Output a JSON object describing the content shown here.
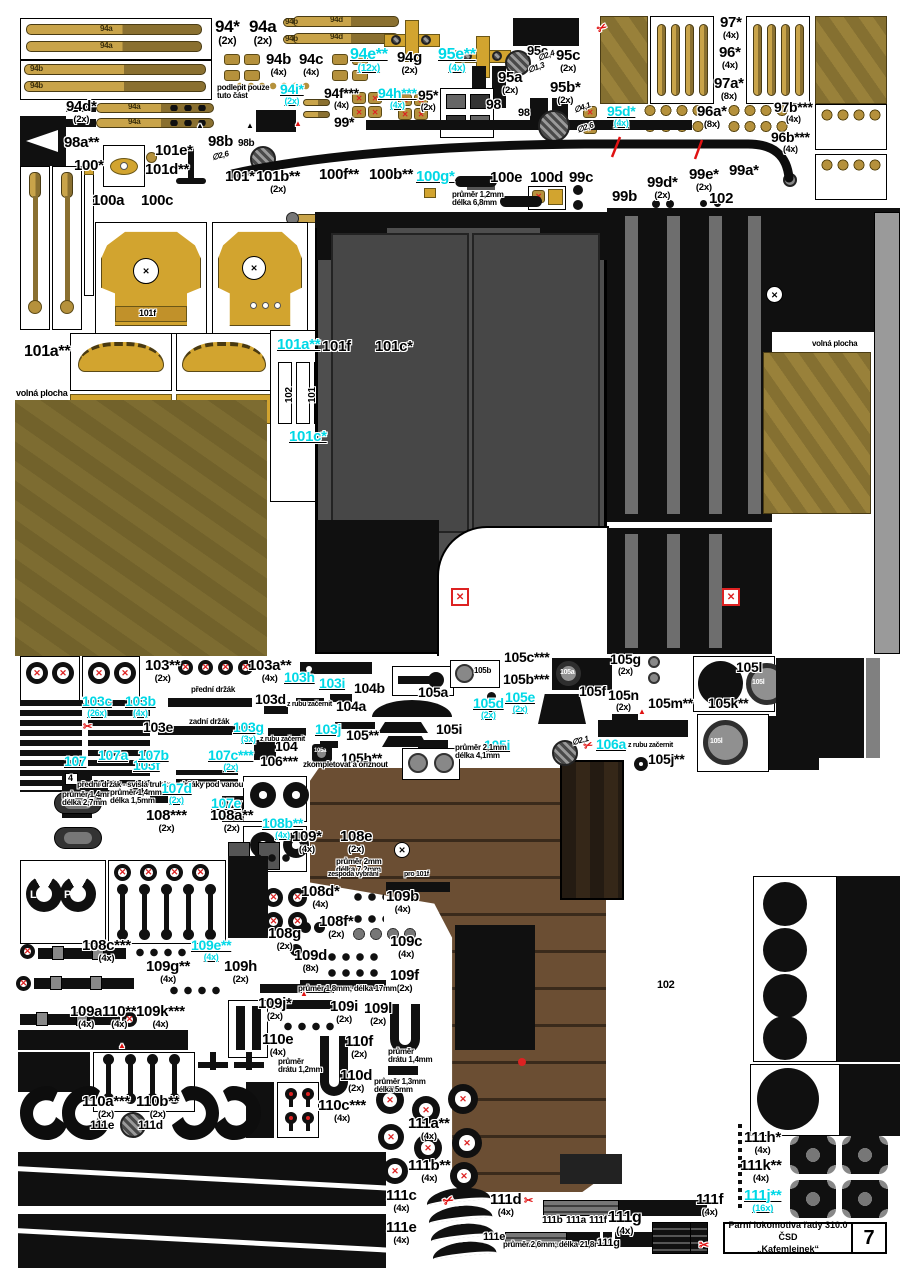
{
  "title_block": {
    "line1": "Parní lokomotiva řady 310.0 ČSD",
    "line2": "„Kafemlejnek“",
    "page": "7"
  },
  "colors": {
    "cyan_accent": "#00d8e6",
    "red_marks": "#e01212",
    "gold": "#c9a44a",
    "dark_gold": "#8a7030",
    "grey_panel": "#4e4e4e",
    "wood": "#6b4e33"
  },
  "labels": [
    {
      "t": "94*",
      "q": "(2x)",
      "x": 215,
      "y": 18,
      "s": 17
    },
    {
      "t": "94a",
      "q": "(2x)",
      "x": 249,
      "y": 18,
      "s": 17
    },
    {
      "t": "94b",
      "q": "(4x)",
      "x": 266,
      "y": 52
    },
    {
      "t": "94c",
      "q": "(4x)",
      "x": 299,
      "y": 52
    },
    {
      "t": "94e**",
      "q": "(12x)",
      "x": 350,
      "y": 47,
      "s": 16,
      "c": "c"
    },
    {
      "t": "94g",
      "q": "(2x)",
      "x": 397,
      "y": 50
    },
    {
      "t": "95e**",
      "q": "(4x)",
      "x": 438,
      "y": 47,
      "s": 16,
      "c": "c"
    },
    {
      "t": "95c",
      "x": 527,
      "y": 44,
      "s": 13
    },
    {
      "t": "95c",
      "q": "(2x)",
      "x": 556,
      "y": 48
    },
    {
      "t": "97*",
      "q": "(4x)",
      "x": 720,
      "y": 15
    },
    {
      "t": "96*",
      "q": "(4x)",
      "x": 719,
      "y": 45
    },
    {
      "t": "97a*",
      "q": "(8x)",
      "x": 714,
      "y": 76
    },
    {
      "t": "94i*",
      "q": "(2x)",
      "x": 280,
      "y": 82,
      "s": 14,
      "c": "c"
    },
    {
      "t": "94f***",
      "q": "(4x)",
      "x": 324,
      "y": 86,
      "s": 14
    },
    {
      "t": "94h***",
      "q": "(4x)",
      "x": 378,
      "y": 86,
      "s": 14,
      "c": "c"
    },
    {
      "t": "95*",
      "q": "(2x)",
      "x": 418,
      "y": 88,
      "s": 14
    },
    {
      "t": "98",
      "x": 486,
      "y": 97,
      "s": 14
    },
    {
      "t": "95a",
      "q": "(2x)",
      "x": 498,
      "y": 70
    },
    {
      "t": "95b*",
      "q": "(2x)",
      "x": 550,
      "y": 80
    },
    {
      "t": "98",
      "x": 518,
      "y": 108,
      "s": 11
    },
    {
      "t": "94d*",
      "q": "(2x)",
      "x": 66,
      "y": 99
    },
    {
      "t": "podlepit pouze\ntuto část",
      "x": 217,
      "y": 84,
      "s": 8
    },
    {
      "t": "99*",
      "x": 334,
      "y": 115,
      "s": 14
    },
    {
      "t": "95d*",
      "q": "(4x)",
      "x": 607,
      "y": 104,
      "s": 14,
      "c": "c"
    },
    {
      "t": "96a*",
      "q": "(8x)",
      "x": 697,
      "y": 104
    },
    {
      "t": "97b***",
      "q": "(4x)",
      "x": 774,
      "y": 100,
      "s": 14
    },
    {
      "t": "96b***",
      "q": "(4x)",
      "x": 771,
      "y": 130,
      "s": 14
    },
    {
      "t": "98a**",
      "x": 64,
      "y": 135
    },
    {
      "t": "98b",
      "x": 208,
      "y": 134
    },
    {
      "t": "98b",
      "x": 238,
      "y": 139,
      "s": 10
    },
    {
      "t": "∅2,6",
      "x": 212,
      "y": 152,
      "s": 8,
      "r": -15,
      "i": 1
    },
    {
      "t": "∅2,4",
      "x": 538,
      "y": 52,
      "s": 8,
      "r": -20,
      "i": 1
    },
    {
      "t": "∅1,3",
      "x": 528,
      "y": 64,
      "s": 8,
      "r": -20,
      "i": 1
    },
    {
      "t": "∅4,1",
      "x": 574,
      "y": 104,
      "s": 8,
      "r": -20,
      "i": 1
    },
    {
      "t": "∅2,6",
      "x": 577,
      "y": 124,
      "s": 8,
      "r": -20,
      "i": 1
    },
    {
      "t": "100*",
      "x": 74,
      "y": 158
    },
    {
      "t": "101e*",
      "x": 155,
      "y": 143
    },
    {
      "t": "101d**",
      "x": 145,
      "y": 162
    },
    {
      "t": "101*",
      "x": 225,
      "y": 169
    },
    {
      "t": "101b**",
      "q": "(2x)",
      "x": 256,
      "y": 169
    },
    {
      "t": "100f**",
      "x": 319,
      "y": 167
    },
    {
      "t": "100b**",
      "x": 369,
      "y": 167
    },
    {
      "t": "100g*",
      "x": 416,
      "y": 169,
      "c": "c"
    },
    {
      "t": "100a",
      "x": 92,
      "y": 193
    },
    {
      "t": "100c",
      "x": 141,
      "y": 193
    },
    {
      "t": "100e",
      "x": 490,
      "y": 170
    },
    {
      "t": "100d",
      "x": 530,
      "y": 170
    },
    {
      "t": "99c",
      "x": 569,
      "y": 170
    },
    {
      "t": "99b",
      "x": 612,
      "y": 189
    },
    {
      "t": "99d*",
      "q": "(2x)",
      "x": 647,
      "y": 175
    },
    {
      "t": "99e*",
      "q": "(2x)",
      "x": 689,
      "y": 167
    },
    {
      "t": "99a*",
      "x": 729,
      "y": 163
    },
    {
      "t": "102",
      "x": 709,
      "y": 191
    },
    {
      "t": "průměr 1,2mm\ndélka 6,8mm",
      "x": 452,
      "y": 191,
      "s": 8
    },
    {
      "t": "101a**",
      "x": 24,
      "y": 344,
      "s": 16
    },
    {
      "t": "volná plocha",
      "x": 16,
      "y": 389,
      "s": 9
    },
    {
      "t": "101a**",
      "x": 277,
      "y": 337,
      "c": "c"
    },
    {
      "t": "101f",
      "x": 322,
      "y": 339
    },
    {
      "t": "101c*",
      "x": 375,
      "y": 339
    },
    {
      "t": "101c*",
      "x": 289,
      "y": 429,
      "c": "c"
    },
    {
      "t": "volná plocha",
      "x": 812,
      "y": 340,
      "s": 8
    },
    {
      "t": "103**",
      "q": "(2x)",
      "x": 145,
      "y": 658
    },
    {
      "t": "103a**",
      "q": "(4x)",
      "x": 248,
      "y": 658
    },
    {
      "t": "103h",
      "x": 284,
      "y": 670,
      "s": 14,
      "c": "c"
    },
    {
      "t": "103i",
      "x": 319,
      "y": 676,
      "s": 14,
      "c": "c"
    },
    {
      "t": "103c",
      "q": "(26x)",
      "x": 82,
      "y": 694,
      "s": 14,
      "c": "c"
    },
    {
      "t": "103b",
      "q": "(4x)",
      "x": 125,
      "y": 694,
      "s": 14,
      "c": "c"
    },
    {
      "t": "103d",
      "x": 255,
      "y": 692,
      "s": 14
    },
    {
      "t": "103e",
      "x": 143,
      "y": 720,
      "s": 14
    },
    {
      "t": "103g",
      "q": "(3x)",
      "x": 233,
      "y": 720,
      "s": 14,
      "c": "c"
    },
    {
      "t": "103f",
      "x": 133,
      "y": 758,
      "s": 14,
      "c": "c"
    },
    {
      "t": "103j",
      "x": 315,
      "y": 722,
      "s": 14,
      "c": "c"
    },
    {
      "t": "105**",
      "x": 346,
      "y": 728,
      "s": 14
    },
    {
      "t": "104",
      "x": 275,
      "y": 739,
      "s": 14
    },
    {
      "t": "105h**",
      "x": 341,
      "y": 751,
      "s": 14
    },
    {
      "t": "přední držák",
      "x": 191,
      "y": 686,
      "s": 8
    },
    {
      "t": "zadní držák",
      "x": 189,
      "y": 718,
      "s": 8
    },
    {
      "t": "z rubu začernit",
      "x": 287,
      "y": 701,
      "s": 7
    },
    {
      "t": "z rubu začernit",
      "x": 260,
      "y": 736,
      "s": 7
    },
    {
      "t": "přední držák - svislá trubka",
      "x": 77,
      "y": 781,
      "s": 8
    },
    {
      "t": "držáky pod vanou",
      "x": 180,
      "y": 781,
      "s": 8
    },
    {
      "t": "104b",
      "x": 354,
      "y": 681,
      "s": 14
    },
    {
      "t": "104a",
      "x": 336,
      "y": 699,
      "s": 14
    },
    {
      "t": "105a",
      "x": 418,
      "y": 685,
      "s": 14
    },
    {
      "t": "105d",
      "q": "(2x)",
      "x": 473,
      "y": 696,
      "s": 14,
      "c": "c"
    },
    {
      "t": "105i",
      "x": 436,
      "y": 722,
      "s": 14
    },
    {
      "t": "105i",
      "x": 484,
      "y": 738,
      "s": 14,
      "c": "c"
    },
    {
      "t": "105e",
      "q": "(2x)",
      "x": 505,
      "y": 690,
      "s": 14,
      "c": "c"
    },
    {
      "t": "105c***",
      "x": 504,
      "y": 650,
      "s": 14
    },
    {
      "t": "105b***",
      "x": 503,
      "y": 672,
      "s": 14
    },
    {
      "t": "105f",
      "x": 579,
      "y": 684,
      "s": 14
    },
    {
      "t": "105g",
      "q": "(2x)",
      "x": 610,
      "y": 652,
      "s": 14
    },
    {
      "t": "105l",
      "x": 736,
      "y": 660,
      "s": 14
    },
    {
      "t": "105n",
      "q": "(2x)",
      "x": 608,
      "y": 688,
      "s": 14
    },
    {
      "t": "105m**",
      "x": 648,
      "y": 696,
      "s": 14
    },
    {
      "t": "105k**",
      "x": 708,
      "y": 696,
      "s": 14
    },
    {
      "t": "z rubu začernit",
      "x": 628,
      "y": 742,
      "s": 7
    },
    {
      "t": "106a",
      "x": 596,
      "y": 737,
      "s": 14,
      "c": "c"
    },
    {
      "t": "105j**",
      "x": 648,
      "y": 752,
      "s": 14
    },
    {
      "t": "∅2,1",
      "x": 572,
      "y": 737,
      "s": 8,
      "r": -15,
      "i": 1
    },
    {
      "t": "průměr 2,1mm\ndélka 4,1mm",
      "x": 455,
      "y": 744,
      "s": 8
    },
    {
      "t": "106***",
      "x": 260,
      "y": 754,
      "s": 14
    },
    {
      "t": "zkompletovat a ořiznout",
      "x": 303,
      "y": 761,
      "s": 8
    },
    {
      "t": "107",
      "x": 64,
      "y": 754,
      "s": 14,
      "c": "c"
    },
    {
      "t": "107a",
      "x": 98,
      "y": 748,
      "s": 14,
      "c": "c"
    },
    {
      "t": "107b",
      "x": 138,
      "y": 748,
      "s": 14,
      "c": "c"
    },
    {
      "t": "107c***",
      "q": "(2x)",
      "x": 208,
      "y": 748,
      "s": 14,
      "c": "c"
    },
    {
      "t": "107d",
      "q": "(2x)",
      "x": 161,
      "y": 781,
      "s": 14,
      "c": "c"
    },
    {
      "t": "107e",
      "q": "(2x)",
      "x": 211,
      "y": 796,
      "s": 14,
      "c": "c"
    },
    {
      "t": "průměr 1,4mm\ndélka 2,7mm",
      "x": 62,
      "y": 791,
      "s": 8
    },
    {
      "t": "průměr 1,4mm\ndélka 1,5mm",
      "x": 110,
      "y": 789,
      "s": 8
    },
    {
      "t": "108***",
      "q": "(2x)",
      "x": 146,
      "y": 808
    },
    {
      "t": "108a**",
      "q": "(2x)",
      "x": 210,
      "y": 808
    },
    {
      "t": "108b**",
      "q": "(4x)",
      "x": 262,
      "y": 816,
      "s": 14,
      "c": "c"
    },
    {
      "t": "109*",
      "q": "(4x)",
      "x": 292,
      "y": 829
    },
    {
      "t": "108e",
      "q": "(2x)",
      "x": 340,
      "y": 829
    },
    {
      "t": "průměr 2mm\ndélka 7,2mm",
      "x": 336,
      "y": 858,
      "s": 8
    },
    {
      "t": "zespoda vybrání",
      "x": 328,
      "y": 871,
      "s": 7
    },
    {
      "t": "pro 101f",
      "x": 404,
      "y": 871,
      "s": 7
    },
    {
      "t": "108d*",
      "q": "(4x)",
      "x": 301,
      "y": 884
    },
    {
      "t": "109b",
      "q": "(4x)",
      "x": 386,
      "y": 889
    },
    {
      "t": "108f*",
      "q": "(2x)",
      "x": 319,
      "y": 914
    },
    {
      "t": "108g",
      "q": "(2x)",
      "x": 268,
      "y": 926
    },
    {
      "t": "109c",
      "q": "(4x)",
      "x": 390,
      "y": 934
    },
    {
      "t": "109d",
      "q": "(8x)",
      "x": 294,
      "y": 948
    },
    {
      "t": "109f",
      "q": "(2x)",
      "x": 390,
      "y": 968
    },
    {
      "t": "průměr 1,8mm; délka 17mm",
      "x": 298,
      "y": 985,
      "s": 8
    },
    {
      "t": "108c***",
      "q": "(4x)",
      "x": 82,
      "y": 938
    },
    {
      "t": "109e**",
      "q": "(4x)",
      "x": 191,
      "y": 938,
      "s": 14,
      "c": "c"
    },
    {
      "t": "109g**",
      "q": "(4x)",
      "x": 146,
      "y": 959
    },
    {
      "t": "109h",
      "q": "(2x)",
      "x": 224,
      "y": 959
    },
    {
      "t": "109a",
      "q": "(4x)",
      "x": 70,
      "y": 1004
    },
    {
      "t": "110**",
      "q": "(4x)",
      "x": 102,
      "y": 1004
    },
    {
      "t": "109k***",
      "q": "(4x)",
      "x": 136,
      "y": 1004
    },
    {
      "t": "109j*",
      "q": "(2x)",
      "x": 258,
      "y": 996
    },
    {
      "t": "109i",
      "q": "(2x)",
      "x": 330,
      "y": 999
    },
    {
      "t": "109l",
      "q": "(2x)",
      "x": 364,
      "y": 1001
    },
    {
      "t": "110e",
      "q": "(4x)",
      "x": 262,
      "y": 1032
    },
    {
      "t": "110f",
      "q": "(2x)",
      "x": 345,
      "y": 1034
    },
    {
      "t": "průměr\ndrátu 1,2mm",
      "x": 278,
      "y": 1058,
      "s": 8
    },
    {
      "t": "průměr\ndrátu 1,4mm",
      "x": 388,
      "y": 1048,
      "s": 8
    },
    {
      "t": "110d",
      "q": "(2x)",
      "x": 340,
      "y": 1068
    },
    {
      "t": "průměr 1,3mm\ndélka 5mm",
      "x": 374,
      "y": 1078,
      "s": 8
    },
    {
      "t": "110c***",
      "q": "(4x)",
      "x": 318,
      "y": 1098
    },
    {
      "t": "110a***",
      "q": "(2x)",
      "x": 82,
      "y": 1094
    },
    {
      "t": "110b**",
      "q": "(2x)",
      "x": 136,
      "y": 1094
    },
    {
      "t": "111e",
      "x": 90,
      "y": 1119,
      "s": 12
    },
    {
      "t": "111d",
      "x": 138,
      "y": 1119,
      "s": 12
    },
    {
      "t": "111a**",
      "q": "(4x)",
      "x": 408,
      "y": 1116
    },
    {
      "t": "111b**",
      "q": "(4x)",
      "x": 408,
      "y": 1158
    },
    {
      "t": "111c",
      "q": "(4x)",
      "x": 386,
      "y": 1188
    },
    {
      "t": "111e",
      "q": "(4x)",
      "x": 386,
      "y": 1220
    },
    {
      "t": "111d",
      "q": "(4x)",
      "x": 490,
      "y": 1192
    },
    {
      "t": "111g",
      "q": "(4x)",
      "x": 608,
      "y": 1210,
      "s": 16
    },
    {
      "t": "111f",
      "q": "(4x)",
      "x": 696,
      "y": 1192
    },
    {
      "t": "111h*",
      "q": "(4x)",
      "x": 744,
      "y": 1130
    },
    {
      "t": "111k**",
      "q": "(4x)",
      "x": 740,
      "y": 1158
    },
    {
      "t": "111j**",
      "q": "(16x)",
      "x": 744,
      "y": 1188,
      "c": "c"
    },
    {
      "t": "102",
      "x": 657,
      "y": 980,
      "s": 11
    },
    {
      "t": "průměr 2,6mm; délka 21,8mm",
      "x": 503,
      "y": 1241,
      "s": 8
    },
    {
      "t": "94a",
      "x": 100,
      "y": 25,
      "s": 8,
      "c": "d"
    },
    {
      "t": "94a",
      "x": 100,
      "y": 42,
      "s": 8,
      "c": "d"
    },
    {
      "t": "94b",
      "x": 30,
      "y": 65,
      "s": 8,
      "c": "d"
    },
    {
      "t": "94b",
      "x": 30,
      "y": 82,
      "s": 8,
      "c": "d"
    },
    {
      "t": "94b",
      "x": 285,
      "y": 18,
      "s": 8,
      "c": "d"
    },
    {
      "t": "94b",
      "x": 285,
      "y": 35,
      "s": 8,
      "c": "d"
    },
    {
      "t": "94d",
      "x": 330,
      "y": 16,
      "s": 8,
      "c": "d"
    },
    {
      "t": "94d",
      "x": 330,
      "y": 33,
      "s": 8,
      "c": "d"
    },
    {
      "t": "94a",
      "x": 128,
      "y": 103,
      "s": 8,
      "c": "d"
    },
    {
      "t": "94a",
      "x": 128,
      "y": 118,
      "s": 8,
      "c": "d"
    },
    {
      "t": "101f",
      "x": 139,
      "y": 309,
      "s": 9
    },
    {
      "t": "102",
      "x": 282,
      "y": 390,
      "s": 10,
      "r": -90
    },
    {
      "t": "101",
      "x": 305,
      "y": 390,
      "s": 10,
      "r": -90
    },
    {
      "t": "L",
      "x": 30,
      "y": 890,
      "s": 11,
      "c": "w"
    },
    {
      "t": "P",
      "x": 64,
      "y": 890,
      "s": 11,
      "c": "w"
    },
    {
      "t": "4",
      "x": 68,
      "y": 774,
      "s": 9
    },
    {
      "t": "105b",
      "x": 474,
      "y": 667,
      "s": 8
    },
    {
      "t": "105a",
      "x": 560,
      "y": 669,
      "s": 7,
      "c": "w"
    },
    {
      "t": "105l",
      "x": 752,
      "y": 679,
      "s": 7,
      "c": "w"
    },
    {
      "t": "105l",
      "x": 710,
      "y": 738,
      "s": 7,
      "c": "w"
    },
    {
      "t": "105a",
      "x": 314,
      "y": 748,
      "s": 6,
      "c": "w"
    },
    {
      "t": "111b",
      "x": 542,
      "y": 1216,
      "s": 10
    },
    {
      "t": "111a",
      "x": 566,
      "y": 1216,
      "s": 10
    },
    {
      "t": "111f",
      "x": 589,
      "y": 1216,
      "s": 10
    },
    {
      "t": "111e",
      "x": 483,
      "y": 1232,
      "s": 11
    },
    {
      "t": "111g",
      "x": 597,
      "y": 1238,
      "s": 11
    },
    {
      "t": "✂",
      "x": 597,
      "y": 22,
      "s": 12,
      "c": "r",
      "r": -30
    },
    {
      "t": "✂",
      "x": 83,
      "y": 722,
      "s": 11,
      "c": "r"
    },
    {
      "t": "✂",
      "x": 584,
      "y": 741,
      "s": 11,
      "c": "r",
      "r": -20
    },
    {
      "t": "✂",
      "x": 443,
      "y": 1194,
      "s": 13,
      "c": "r",
      "r": -25
    },
    {
      "t": "✂",
      "x": 524,
      "y": 1196,
      "s": 11,
      "c": "r"
    },
    {
      "t": "✂",
      "x": 699,
      "y": 1239,
      "s": 12,
      "c": "r"
    },
    {
      "t": "▲",
      "x": 196,
      "y": 122,
      "s": 8
    },
    {
      "t": "▲",
      "x": 246,
      "y": 122,
      "s": 8
    },
    {
      "t": "▲",
      "x": 294,
      "y": 120,
      "s": 8,
      "c": "r"
    },
    {
      "t": "▲",
      "x": 638,
      "y": 708,
      "s": 8,
      "c": "r"
    },
    {
      "t": "▲",
      "x": 118,
      "y": 1042,
      "s": 8,
      "c": "r"
    },
    {
      "t": "▲",
      "x": 300,
      "y": 990,
      "s": 8,
      "c": "r"
    }
  ]
}
